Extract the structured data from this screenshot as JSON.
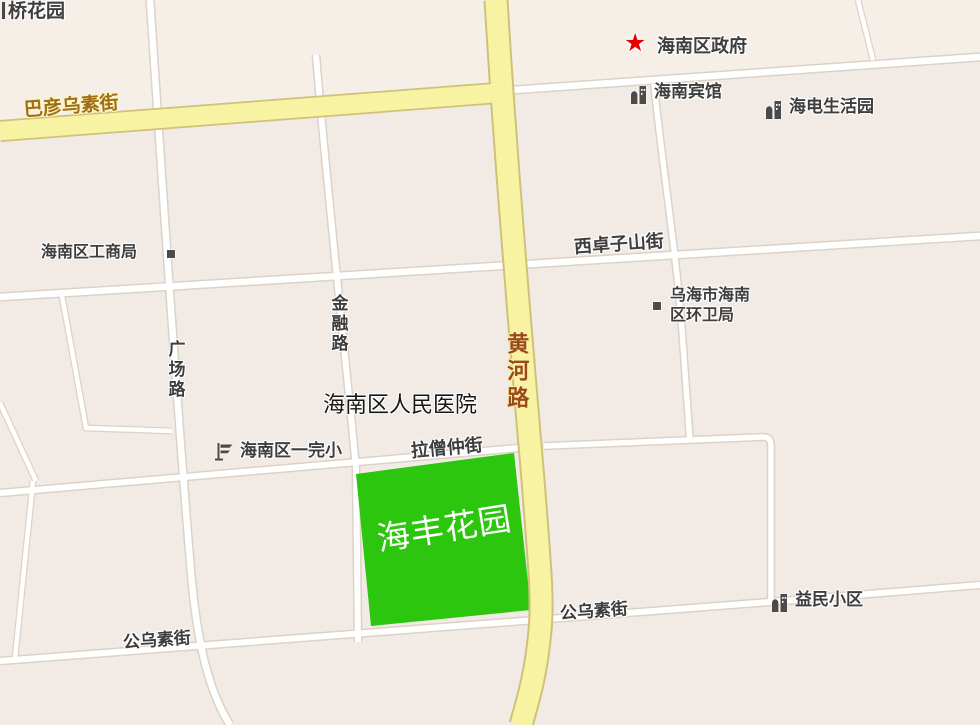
{
  "map": {
    "highlighted_area": "海丰花园",
    "labels": {
      "qiaohuayuan": "桥花园",
      "bayanwusu_street": "巴彦乌素街",
      "hainan_government": "海南区政府",
      "hainan_hotel": "海南宾馆",
      "haidian_life_park": "海电生活园",
      "gongshang_bureau": "海南区工商局",
      "xizhuozishan_street": "西卓子山街",
      "huanwei_bureau_line1": "乌海市海南",
      "huanwei_bureau_line2": "区环卫局",
      "jinrong_road": "金融路",
      "guangchang_road": "广场路",
      "huanghe_road": "黄河路",
      "peoples_hospital": "海南区人民医院",
      "yiwan_primary_school": "海南区一完小",
      "lasengzhong_street": "拉僧仲街",
      "haifeng_garden": "海丰花园",
      "gongwusu_street_west": "公乌素街",
      "gongwusu_street_east": "公乌素街",
      "yimin_community": "益民小区"
    },
    "glyphs": {
      "star": "★"
    },
    "icons": {
      "government": "red-star-icon",
      "hotel": "building-icon",
      "haidian": "building-icon",
      "yimin": "building-icon",
      "school": "flag-icon",
      "gongshang": "small-square-icon",
      "huanwei": "small-square-icon"
    },
    "colors": {
      "background": "#f2ebe5",
      "minor_road_fill": "#ffffff",
      "minor_road_border": "#dcd2c6",
      "major_road_fill": "#f8f3a2",
      "major_road_border": "#d0c07c",
      "highlight_green": "#2bc60d",
      "poi_text": "#3e3e3e",
      "huanghe_label": "#9a4a1c",
      "bayan_label": "#a06e16",
      "star_red": "#e60000"
    }
  }
}
